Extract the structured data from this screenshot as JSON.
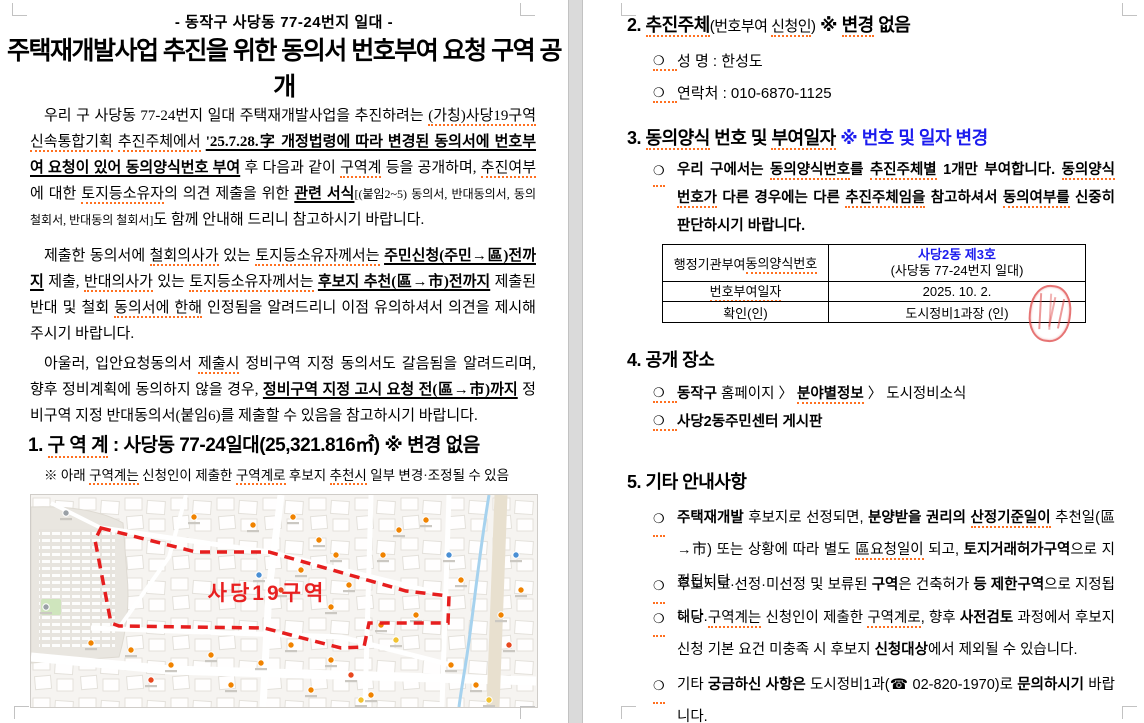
{
  "glyphs": {
    "bullet": "❍"
  },
  "colors": {
    "accent_blue": "#1b1bee",
    "boundary_red": "#e61e1e",
    "stamp_red": "#de4646",
    "spellcheck_orange": "#ff7020"
  },
  "page_left": {
    "subtitle": "- 동작구 사당동 77-24번지 일대 -",
    "title": "주택재개발사업 추진을 위한 동의서 번호부여 요청 구역 공개",
    "p1": [
      {
        "t": "우리 구 사당동 77-24번지 일대 주택재개발사업을 추진하려는 "
      },
      {
        "t": "(가칭)사당19구역",
        "sp": 1
      },
      {
        "t": " "
      },
      {
        "t": "신속통합기획",
        "sp": 1
      },
      {
        "t": " "
      },
      {
        "t": "추진주체에서",
        "sp": 1
      },
      {
        "t": " "
      },
      {
        "t": "'25.7.28.字 개정법령에 따라 변경된 동의서에 번호부여 요청이 있어 동의양식번호 부여",
        "b": 1,
        "u": 1
      },
      {
        "t": " 후 다음과 같이 "
      },
      {
        "t": "구역계",
        "sp": 1
      },
      {
        "t": " 등을 공개하며, "
      },
      {
        "t": "추진여부",
        "sp": 1
      },
      {
        "t": "에 대한 "
      },
      {
        "t": "토지등소유자",
        "sp": 1
      },
      {
        "t": "의 의견 제출을 위한 "
      },
      {
        "t": "관련 서식",
        "b": 1,
        "u": 1
      },
      {
        "t": "[(붙임2~5) 동의서, 반대동의서, 동의 철회서, 반대동의 철회서]",
        "sm": 1
      },
      {
        "t": "도 함께 안내해 드리니 참고하시기 바랍니다."
      }
    ],
    "p2": [
      {
        "t": "제출한 동의서에 "
      },
      {
        "t": "철회의사가",
        "sp": 1
      },
      {
        "t": " 있는 "
      },
      {
        "t": "토지등소유자께서는",
        "sp": 1
      },
      {
        "t": " "
      },
      {
        "t": "주민신청(주민→區)전까지",
        "b": 1,
        "u": 1
      },
      {
        "t": " 제출, "
      },
      {
        "t": "반대의사가",
        "sp": 1
      },
      {
        "t": " 있는 "
      },
      {
        "t": "토지등소유자께서는",
        "sp": 1
      },
      {
        "t": " "
      },
      {
        "t": "후보지 추천(區→市)전까지",
        "b": 1,
        "u": 1
      },
      {
        "t": " 제출된 반대 및 철회 "
      },
      {
        "t": "동의서에 한해",
        "sp": 1
      },
      {
        "t": " 인정됨을 알려드리니 이점 유의하셔서 의견을 제시해 주시기 바랍니다."
      }
    ],
    "p3": [
      {
        "t": "아울러, 입안요청동의서 "
      },
      {
        "t": "제출시",
        "sp": 1
      },
      {
        "t": " 정비구역 지정 동의서도 갈음됨을 알려드리며, 향후 정비계획에 동의하지 않을 경우, "
      },
      {
        "t": "정비구역 지정 고시 요청 전(區→市)까지",
        "b": 1,
        "u": 1
      },
      {
        "t": " 정비구역 지정 반대동의서(붙임6)를 제출할 수 있음을 참고하시기 바랍니다."
      }
    ],
    "h1": [
      {
        "t": "1. ",
        "b": 1
      },
      {
        "t": "구 역 계",
        "b": 1,
        "sp": 1
      },
      {
        "t": " : 사당동 77-24일대(25,321.816㎡) ",
        "b": 1
      },
      {
        "t": "※ 변경 없음",
        "b": 1
      }
    ],
    "note": [
      {
        "t": "※ 아래 "
      },
      {
        "t": "구역계는",
        "sp": 1
      },
      {
        "t": " 신청인이 제출한 "
      },
      {
        "t": "구역계로",
        "sp": 1
      },
      {
        "t": " 후보지 "
      },
      {
        "t": "추천시",
        "sp": 1
      },
      {
        "t": " 일부 변경·조정될 수 있음"
      }
    ],
    "map": {
      "label": "사당19구역",
      "label_x": 236,
      "label_y": 105,
      "label_color": "#e82020",
      "boundary_color": "#e61e1e",
      "polygon": "70,33 165,57 238,57 375,96 418,101 417,128 338,128 333,152 310,153 233,133 88,131 80,128 64,45",
      "marker_colors": {
        "o": "#f08300",
        "r": "#e8481f",
        "b": "#4a8fd4",
        "y": "#f2c230",
        "g": "#9aa0a6"
      },
      "markers": [
        [
          163,
          22,
          "o"
        ],
        [
          222,
          30,
          "o"
        ],
        [
          262,
          22,
          "o"
        ],
        [
          288,
          45,
          "o"
        ],
        [
          305,
          60,
          "o"
        ],
        [
          228,
          80,
          "b"
        ],
        [
          250,
          95,
          "r"
        ],
        [
          270,
          75,
          "o"
        ],
        [
          300,
          112,
          "o"
        ],
        [
          318,
          90,
          "o"
        ],
        [
          352,
          60,
          "o"
        ],
        [
          368,
          35,
          "o"
        ],
        [
          395,
          25,
          "o"
        ],
        [
          418,
          60,
          "b"
        ],
        [
          430,
          85,
          "o"
        ],
        [
          350,
          130,
          "o"
        ],
        [
          365,
          145,
          "y"
        ],
        [
          385,
          120,
          "o"
        ],
        [
          300,
          165,
          "o"
        ],
        [
          320,
          180,
          "r"
        ],
        [
          260,
          150,
          "o"
        ],
        [
          230,
          168,
          "o"
        ],
        [
          180,
          160,
          "o"
        ],
        [
          140,
          170,
          "o"
        ],
        [
          100,
          155,
          "o"
        ],
        [
          60,
          148,
          "o"
        ],
        [
          120,
          185,
          "r"
        ],
        [
          200,
          190,
          "o"
        ],
        [
          280,
          195,
          "o"
        ],
        [
          340,
          200,
          "o"
        ],
        [
          420,
          170,
          "o"
        ],
        [
          445,
          190,
          "o"
        ],
        [
          470,
          120,
          "o"
        ],
        [
          478,
          150,
          "r"
        ],
        [
          485,
          60,
          "b"
        ],
        [
          490,
          95,
          "o"
        ],
        [
          35,
          18,
          "g"
        ],
        [
          15,
          112,
          "g"
        ],
        [
          330,
          205,
          "y"
        ],
        [
          458,
          205,
          "y"
        ]
      ]
    }
  },
  "page_right": {
    "h2": [
      {
        "t": "2. ",
        "b": 1
      },
      {
        "t": "추진주체",
        "b": 1,
        "sp": 1
      },
      {
        "t": "(번호부여 ",
        "m": 1
      },
      {
        "t": "신청인",
        "m": 1,
        "sp": 1
      },
      {
        "t": ")",
        "m": 1
      },
      {
        "t": "  ※ ",
        "b": 1
      },
      {
        "t": "변경",
        "b": 1,
        "sp": 1
      },
      {
        "t": " 없음",
        "b": 1
      }
    ],
    "s2_item1": "성  명 : 한성도",
    "s2_item2": "연락처 : 010-6870-1125",
    "h3": [
      {
        "t": "3. ",
        "b": 1
      },
      {
        "t": "동의양식",
        "b": 1,
        "sp": 1
      },
      {
        "t": " 번호 및 ",
        "b": 1
      },
      {
        "t": "부여일자",
        "b": 1,
        "sp": 1
      },
      {
        "t": "  ",
        "b": 1
      },
      {
        "t": "※ 번호 및 일자 변경",
        "b": 1,
        "c": "#1b1bee"
      }
    ],
    "s3_para": [
      {
        "t": "우리 구에서는 "
      },
      {
        "t": "동의양식번호",
        "sp": 1
      },
      {
        "t": "를 "
      },
      {
        "t": "추진주체별",
        "sp": 1
      },
      {
        "t": " 1개만 부여합니다. "
      },
      {
        "t": "동의양식",
        "sp": 1
      },
      {
        "t": " "
      },
      {
        "t": "번호가",
        "sp": 1
      },
      {
        "t": " 다른 경우에는 다른 "
      },
      {
        "t": "추진주체임을",
        "sp": 1
      },
      {
        "t": " 참고하셔서 "
      },
      {
        "t": "동의여부를",
        "sp": 1
      },
      {
        "t": " 신중히 판단하시기 바랍니다."
      }
    ],
    "table": {
      "r1_label": [
        {
          "t": "행정기관부여 "
        },
        {
          "t": "동의양식번호",
          "sp": 1
        }
      ],
      "r1_value_line1": "사당2동 제3호",
      "r1_value_line2": "(사당동 77-24번지 일대)",
      "r2_label": [
        {
          "t": "번호부여일자",
          "sp": 1
        }
      ],
      "r2_value": "2025. 10. 2.",
      "r3_label": "확인(인)",
      "r3_value": "도시정비1과장 (인)"
    },
    "h4": [
      {
        "t": "4. 공개 장소",
        "b": 1
      }
    ],
    "s4_item1": [
      {
        "t": "동작구",
        "b": 1
      },
      {
        "t": " 홈페이지 〉 "
      },
      {
        "t": "분야별정보",
        "b": 1,
        "sp": 1
      },
      {
        "t": " 〉 도시정비소식"
      }
    ],
    "s4_item2": [
      {
        "t": "사당2동주민센터 게시판",
        "b": 1
      }
    ],
    "h5": [
      {
        "t": "5. 기타 안내사항",
        "b": 1
      }
    ],
    "s5_item1": [
      {
        "t": "주택재개발",
        "b": 1
      },
      {
        "t": " 후보지로 선정되면, "
      },
      {
        "t": "분양받을 권리의",
        "b": 1
      },
      {
        "t": " "
      },
      {
        "t": "산정기준일이",
        "b": 1,
        "sp": 1
      },
      {
        "t": " 추천일(區→市) 또는 상황에 따라 별도 "
      },
      {
        "t": "區요청일이",
        "sp": 1
      },
      {
        "t": " 되고, "
      },
      {
        "t": "토지거래허가구역",
        "b": 1
      },
      {
        "t": "으로 지정됩니다."
      }
    ],
    "s5_item2": [
      {
        "t": "후보지로 선정·미선정 및 보류된 "
      },
      {
        "t": "구역",
        "b": 1
      },
      {
        "t": "은 건축허가 "
      },
      {
        "t": "등 제한구역",
        "b": 1
      },
      {
        "t": "으로 지정됩니다."
      }
    ],
    "s5_item3": [
      {
        "t": "해당 "
      },
      {
        "t": "구역계는",
        "sp": 1
      },
      {
        "t": " 신청인이 제출한 "
      },
      {
        "t": "구역계로",
        "sp": 1
      },
      {
        "t": ", 향후 "
      },
      {
        "t": "사전검토",
        "b": 1
      },
      {
        "t": " 과정에서 후보지 신청 기본 요건 미충족 시 후보지 "
      },
      {
        "t": "신청대상",
        "b": 1
      },
      {
        "t": "에서 제외될 수 있습니다."
      }
    ],
    "s5_item4": [
      {
        "t": "기타 "
      },
      {
        "t": "궁금하신 사항은",
        "b": 1
      },
      {
        "t": " 도시정비1과(☎ 02-820-1970)로 "
      },
      {
        "t": "문의하시기",
        "b": 1
      },
      {
        "t": " 바랍니다."
      }
    ]
  }
}
